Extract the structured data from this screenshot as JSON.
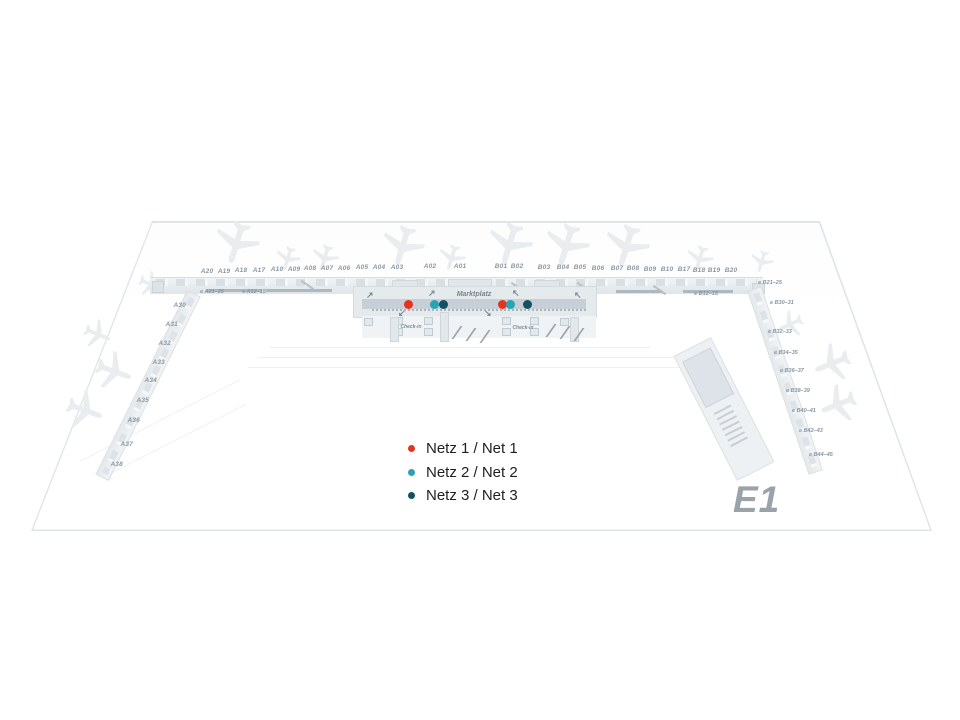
{
  "map": {
    "floor_label": "E1",
    "marktplatz_label": "Marktplatz",
    "checkin_label_left": "Check-in",
    "checkin_label_right": "Check-in",
    "gates": {
      "a_top": [
        "A20",
        "A19",
        "A18",
        "A17",
        "A10",
        "A09",
        "A08",
        "A07",
        "A06",
        "A05",
        "A04",
        "A03",
        "A02",
        "A01"
      ],
      "b_top": [
        "B01",
        "B02",
        "B03",
        "B04",
        "B05",
        "B06",
        "B07",
        "B08",
        "B09",
        "B10",
        "B17",
        "B18",
        "B19",
        "B20"
      ],
      "e_top": [
        "e A21–25",
        "e A12–15",
        "e B12–15",
        "e B21–25"
      ],
      "a_pier": [
        "A30",
        "A31",
        "A32",
        "A33",
        "A34",
        "A35",
        "A36",
        "A37",
        "A38"
      ],
      "b_pier": [
        "e B30–31",
        "e B32–33",
        "e B34–35",
        "e B36–37",
        "e B38–39",
        "e B40–41",
        "e B42–43",
        "e B44–45"
      ]
    }
  },
  "icons": {
    "arrow_ne": "↗",
    "arrow_nw": "↖",
    "arrow_sw": "↙",
    "arrow_se": "↘"
  },
  "legend": {
    "items": [
      {
        "label": "Netz 1 / Net 1",
        "color": "#e5341c"
      },
      {
        "label": "Netz 2 / Net 2",
        "color": "#2aa3b5"
      },
      {
        "label": "Netz 3 / Net 3",
        "color": "#155060"
      }
    ]
  }
}
